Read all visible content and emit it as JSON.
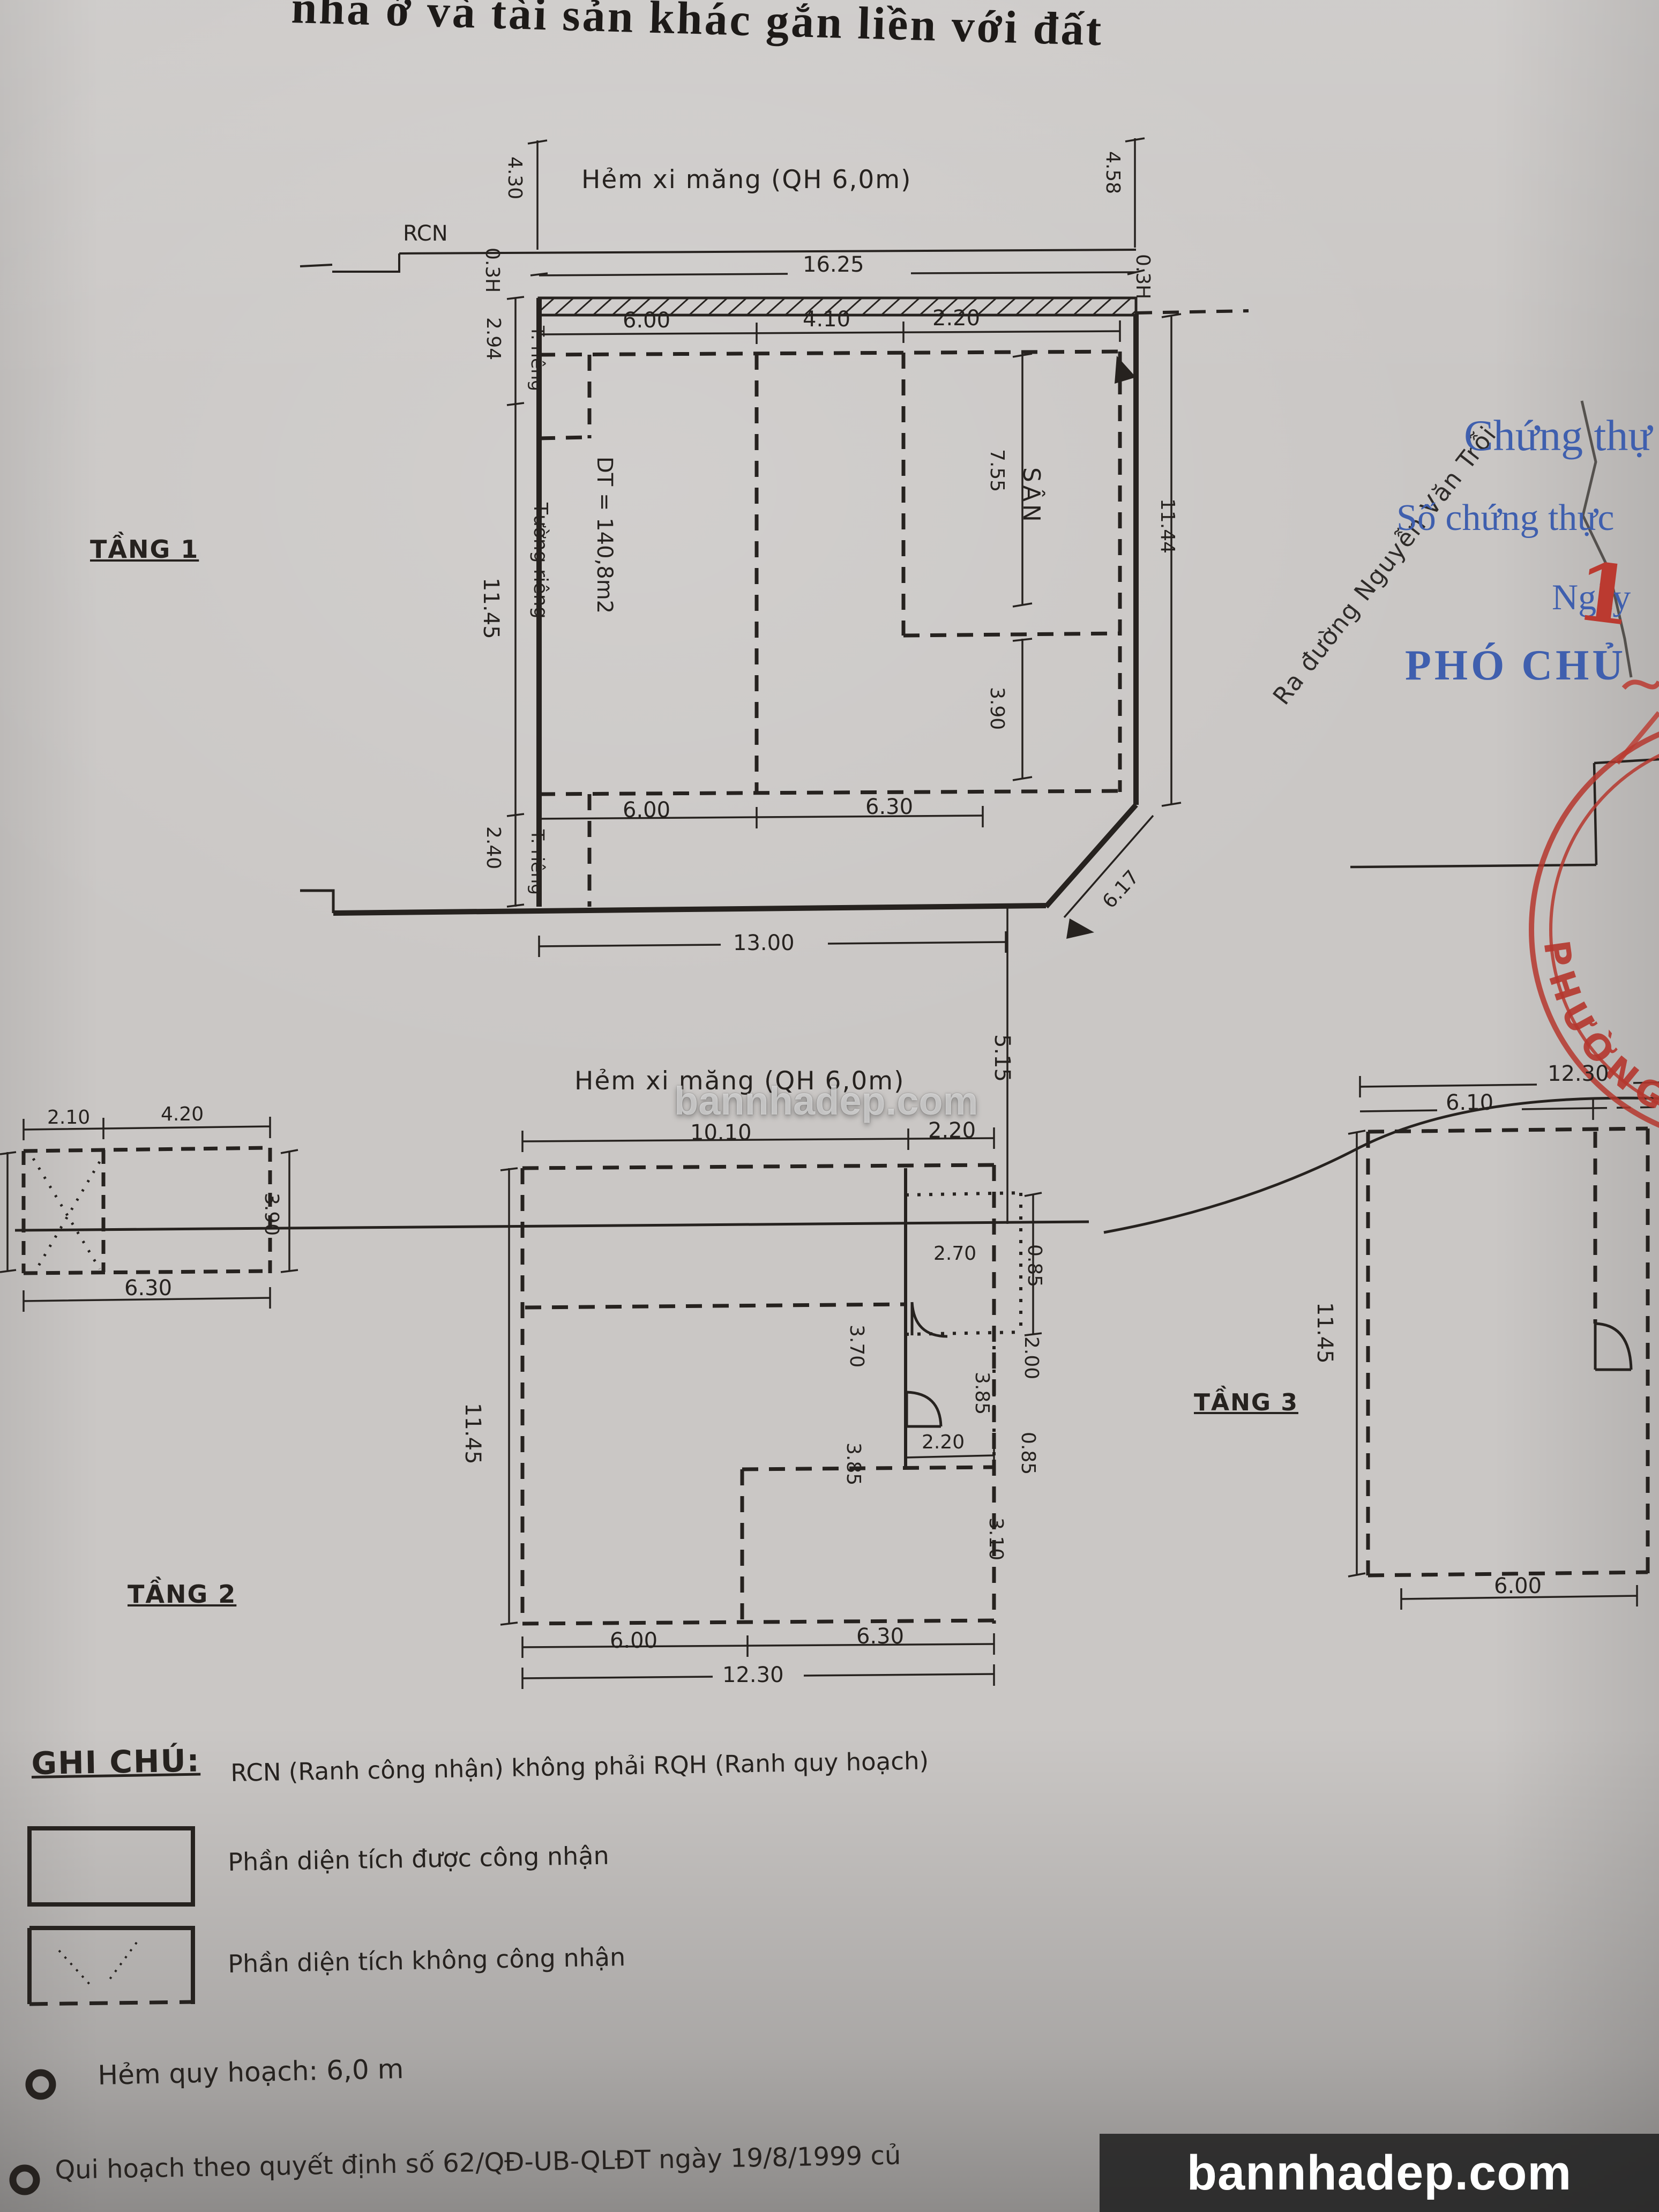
{
  "page": {
    "title": "nhà ở và tài sản khác gắn liền với đất"
  },
  "colors": {
    "ink": "#26221f",
    "blue": "#3f5fae",
    "red": "#b5372e",
    "paper": "#cac7c5"
  },
  "floor1": {
    "label": "TẦNG 1",
    "street_top": "Hẻm xi măng (QH 6,0m)",
    "street_bottom": "Hẻm xi măng (QH 6,0m)",
    "street_right": "Ra đường Nguyễn Văn Trỗi",
    "rcn": "RCN",
    "area": "DT = 140,8m2",
    "yard": "SÂN",
    "wall_top": "T. riêng",
    "wall_mid": "Tường riêng",
    "wall_bottom": "T. riêng",
    "dims": {
      "top_width": "16.25",
      "left_up": "4.30",
      "left_offset": "0.3H",
      "right_up": "4.58",
      "right_offset": "0.3H",
      "left_a": "2.94",
      "left_b": "11.45",
      "left_c": "2.40",
      "in_top_a": "6.00",
      "in_top_b": "4.10",
      "in_top_c": "2.20",
      "yard_a": "7.55",
      "yard_b": "3.90",
      "in_bot_a": "6.00",
      "in_bot_b": "6.30",
      "bottom_width": "13.00",
      "right_side": "11.44",
      "diag": "6.17",
      "alley_gap": "5.15"
    }
  },
  "floor2": {
    "label": "TẦNG 2",
    "dims": {
      "top_a": "10.10",
      "top_b": "2.20",
      "balc_a": "0.85",
      "balc_b": "2.00",
      "balc_c": "0.85",
      "balc_w": "2.70",
      "mid_a": "3.70",
      "mid_b": "3.85",
      "mid_r": "3.85",
      "mid_c": "2.20",
      "low_r": "3.10",
      "left": "11.45",
      "bot_a": "6.00",
      "bot_b": "6.30",
      "bot_w": "12.30"
    }
  },
  "floor3": {
    "label": "TẦNG 3",
    "dims": {
      "top_w": "12.30",
      "top_a": "6.10",
      "left": "11.45",
      "bot": "6.00"
    }
  },
  "annex": {
    "dims": {
      "top_a": "2.10",
      "top_b": "4.20",
      "side_l": "3.90",
      "side_r": "3.90",
      "bot": "6.30"
    }
  },
  "notes": {
    "heading": "GHI CHÚ:",
    "line1": "RCN (Ranh công nhận) không phải RQH (Ranh quy hoạch)",
    "legend1": "Phần diện tích được công nhận",
    "legend2": "Phần diện tích không công nhận",
    "bullet1": "Hẻm quy hoạch: 6,0 m",
    "bullet2": "Qui hoạch theo quyết định số 62/QĐ-UB-QLĐT ngày 19/8/1999 củ"
  },
  "cert": {
    "line1": "Chứng thự",
    "line2": "Số chứng thực",
    "line3": "Ngày",
    "line4": "PHÓ CHỦ",
    "hand_digit": "1",
    "stamp_arc_text": "PHƯỜNG PH"
  },
  "watermark": {
    "center": "bannhadep.com",
    "bottom": "bannhadep.com"
  }
}
